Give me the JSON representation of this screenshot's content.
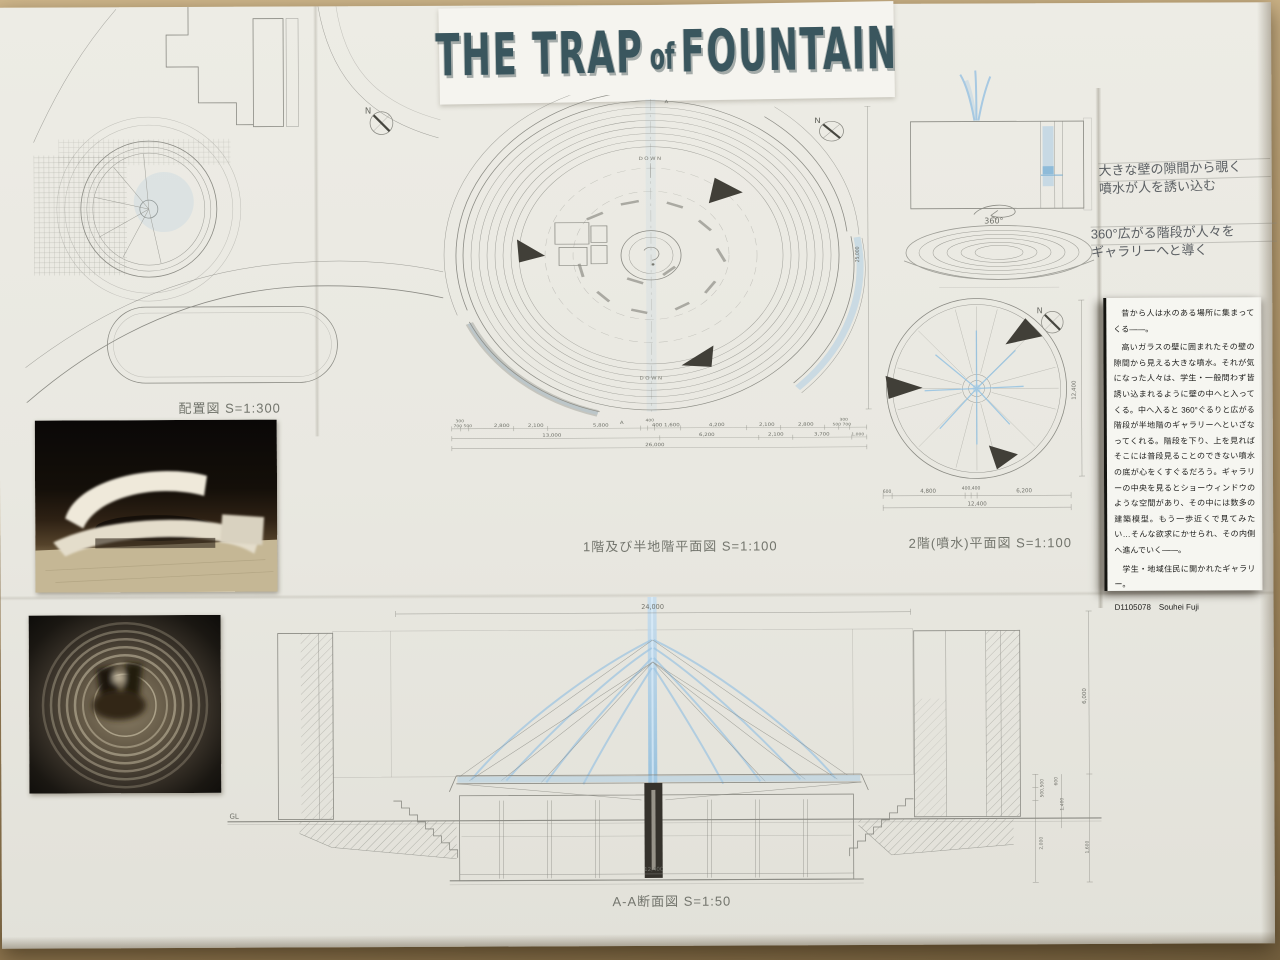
{
  "title": {
    "part1": "THE TRAP",
    "part2": "of",
    "part3": "FOUNTAIN"
  },
  "compass": {
    "n": "N"
  },
  "site_plan": {
    "label": "配置図 S=1:300"
  },
  "main_plan": {
    "label": "1階及び半地階平面図 S=1:100",
    "down_top": "DOWN",
    "down_bottom": "DOWN",
    "section_mark": "A",
    "dim_small": [
      "300",
      "400",
      "300"
    ],
    "dim_row1": [
      "700 500",
      "2,800",
      "2,100",
      "5,800",
      "400 1,600",
      "4,200",
      "2,100",
      "2,800",
      "500 700"
    ],
    "dim_row2": [
      "13,000",
      "6,200",
      "2,100",
      "3,700",
      "1,000"
    ],
    "dim_total": "26,000",
    "dim_vertical": "25,000"
  },
  "upper_plan": {
    "label": "2階(噴水)平面図 S=1:100",
    "dim_row1": [
      "600",
      "4,800",
      "400,400",
      "6,200"
    ],
    "dim_total": "12,400",
    "dim_vertical": "12,400"
  },
  "sketches": {
    "caption_wall": "大きな壁の隙間から覗く\n噴水が人を誘い込む",
    "caption_stairs": "360°広がる階段が人々を\nギャラリーへと導く",
    "rotation_note": "360°"
  },
  "description": {
    "para1": "昔から人は水のある場所に集まってくる――。",
    "para2": "高いガラスの壁に囲まれたその壁の隙間から見える大きな噴水。それが気になった人々は、学生・一般問わず皆誘い込まれるように壁の中へと入ってくる。中へ入ると 360°ぐるりと広がる階段が半地階のギャラリーへといざなってくれる。階段を下り、上を見ればそこには普段見ることのできない噴水の底が心をくすぐるだろう。ギャラリーの中央を見るとショーウィンドウのような空間があり、その中には数多の建築模型。もう一歩近くで見てみたい…そんな欲求にかせられ、その内側へ進んでいく――。",
    "para3": "学生・地域住民に開かれたギャラリー。",
    "credit": "D1105078　Souhei Fuji"
  },
  "section": {
    "label": "A-A断面図 S=1:50",
    "gl": "GL",
    "dim_top": "24,000",
    "dim_bottom": "12,400",
    "dim_right": [
      "6,000",
      "500,500",
      "600",
      "1,400",
      "2,000",
      "1,600"
    ]
  },
  "colors": {
    "pencil": "#8b8b84",
    "blue": "#8fc0e2",
    "title": "#3a565e",
    "paper": "#e9e8e1",
    "table": "#b59c73"
  }
}
